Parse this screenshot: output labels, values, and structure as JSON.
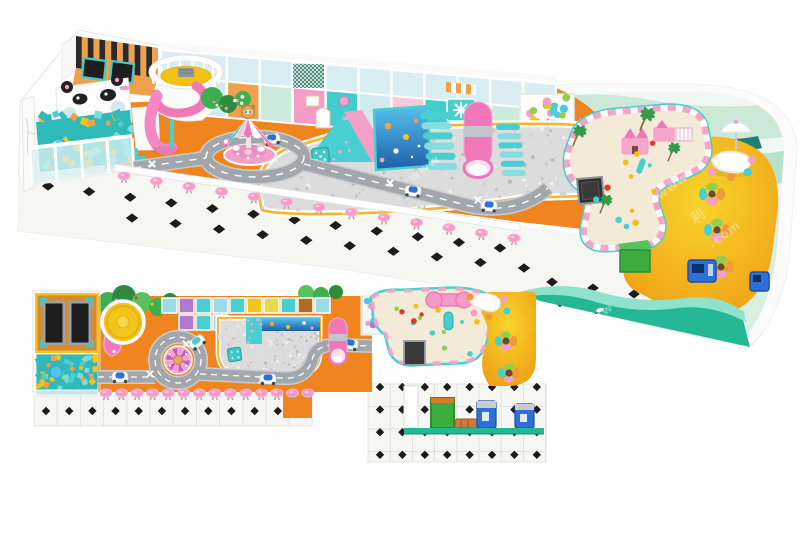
{
  "meta": {
    "subject": "indoor playground 3d design render",
    "views": [
      "perspective-render",
      "top-down-floor-plan"
    ]
  },
  "palette": {
    "orange": "#F0841E",
    "orangeSoft": "#F29A3E",
    "orangeWall": "#F0A04A",
    "yellow": "#F2C51D",
    "gold": "#F6B52A",
    "pink": "#F49BC8",
    "pinkHot": "#F078B8",
    "pinkPale": "#F6C9DD",
    "teal": "#43CCCC",
    "tealDeep": "#2FA8A8",
    "glass": "#D8EEF2",
    "mint": "#CDEBDC",
    "mintDark": "#A8DCC4",
    "waveDark": "#1E7F72",
    "road": "#A2A7AB",
    "roadLight": "#C9CDD0",
    "ballGrey": "#DCDCDC",
    "dark": "#2A2A2A",
    "sand": "#F3EAD8",
    "tile": "#F6F6F2",
    "tileLine": "#DEDED8",
    "green": "#3FAE4E",
    "greenDark": "#2E8B3D",
    "boxGreen": "#3DAE3D",
    "blue": "#2E6FD8",
    "blueDark": "#1D4FA8",
    "red": "#E03A2F",
    "purple": "#B07AD0",
    "trim": "#25B894",
    "trimLight": "#8FE3CE",
    "white": "#FFFFFF",
    "frame": "#E8ECEA",
    "bear": "#E0A860"
  },
  "watermark": {
    "fragments": [
      "www",
      ".com",
      "乐",
      "利"
    ]
  },
  "zones": {
    "perspective": [
      "trampoline-room",
      "panda-partition",
      "foam-cube-pit",
      "spiral-slide-tower",
      "carousel",
      "toy-road",
      "play-structure-panels",
      "white-ball-pit",
      "climbing-wedge",
      "ocean-mural",
      "roller-stairs",
      "tube-slide",
      "castle-arches",
      "ball-pool",
      "sand-play-area",
      "cafe-area",
      "bean-table",
      "pink-stool-row",
      "tile-floor",
      "wavy-wall",
      "arcade-machines",
      "storage-box"
    ],
    "plan": [
      "trampoline-room",
      "foam-cube-pit",
      "slide-tower",
      "tree-band",
      "panel-grid",
      "ball-pit",
      "tube-slide",
      "ball-pool",
      "toy-road",
      "roundabout-carousel",
      "sand-play-area",
      "chalkboard",
      "cafe-area",
      "stool-row",
      "tile-floor",
      "machines",
      "storage-box"
    ]
  },
  "gen": {
    "u_stripes": {
      "type": "stripes",
      "quad": [
        [
          76,
          36
        ],
        [
          158,
          48
        ],
        [
          158,
          78
        ],
        [
          76,
          68
        ]
      ],
      "n": 14,
      "colors": [
        "#2A2A2A",
        "#F0A04A"
      ]
    },
    "u_foam": {
      "type": "cubes",
      "rect": [
        40,
        114,
        92,
        54
      ],
      "n": 64,
      "size": [
        4,
        8
      ],
      "colors": [
        "#49CFCF",
        "#F0A04A",
        "#F2C51D",
        "#7ADCDC",
        "#2FB9B9",
        "#38B8B8"
      ],
      "seed": 7,
      "clip": "clipFoamU"
    },
    "u_panels": {
      "type": "panels",
      "x1": 161,
      "y1": 50,
      "x2": 556,
      "y2": 84,
      "n": 12,
      "hTop": 26,
      "hBot": 36,
      "glass": "#D8EEF2",
      "colors": [
        "#F6C9DD",
        "#CFEAF0",
        "#F0A04A",
        "#CDEBDC",
        "#F49BC8",
        "#43CCCC",
        "#CFEAF0",
        "#F6C9DD",
        "#43CCCC",
        "#F0A04A",
        "#CDEBDC",
        "#CFEAF0"
      ]
    },
    "u_net": {
      "type": "net",
      "rect": [
        293,
        64,
        31,
        24
      ],
      "step": 4,
      "color": "#2E6E4E"
    },
    "u_awning": {
      "type": "stripes",
      "quad": [
        [
          446,
          82
        ],
        [
          476,
          85
        ],
        [
          476,
          95
        ],
        [
          446,
          92
        ]
      ],
      "n": 6,
      "colors": [
        "#F0A04A",
        "#FFFFFF"
      ]
    },
    "u_bushdots": {
      "type": "balls",
      "rect": [
        202,
        90,
        46,
        22
      ],
      "n": 10,
      "r": [
        1,
        2
      ],
      "colors": [
        "#F49BC8",
        "#F0A04A",
        "#FFFFFF"
      ],
      "seed": 3
    },
    "u_rails": {
      "type": "rails",
      "cx": 186,
      "cy": 72,
      "rx": 33,
      "ry": 13.5,
      "n": 12,
      "len": 10,
      "color": "#FFFFFF",
      "a0": 150,
      "a1": 390
    },
    "u_sectors": {
      "type": "sectors",
      "cx": 248,
      "cy": 144,
      "rx": 23,
      "ry": 8.5,
      "apex": [
        248,
        118
      ],
      "n": 9,
      "colors": [
        "#F078B8",
        "#FFFFFF",
        "#49CFCF",
        "#F6C9DD"
      ],
      "a0": 160,
      "a1": 380,
      "dots": true
    },
    "u_speckle": {
      "type": "balls",
      "rect": [
        260,
        128,
        352,
        88
      ],
      "n": 240,
      "r": [
        1,
        2.3
      ],
      "colors": [
        "#C9C9C9",
        "#EFEFEF",
        "#BDBDBD",
        "#E2E2E2",
        "#D4D4D4"
      ],
      "seed": 13,
      "clip": "clipPitU"
    },
    "u_wedgedots": {
      "type": "balls",
      "rect": [
        312,
        118,
        54,
        42
      ],
      "n": 13,
      "r": [
        1.2,
        1.9
      ],
      "colors": [
        "#F6A8CC"
      ],
      "seed": 5,
      "clip": "clipWedge"
    },
    "u_castleballs": {
      "type": "balls",
      "rect": [
        524,
        97,
        46,
        26
      ],
      "n": 16,
      "r": [
        3,
        4.4
      ],
      "colors": [
        "#8FD14F",
        "#4FC8E8",
        "#B07AD0",
        "#F2A0C8",
        "#F6C51D",
        "#49CFCF"
      ],
      "seed": 9
    },
    "u_bars1": {
      "type": "bars",
      "x": 420,
      "y": 112,
      "w": 30,
      "h": 7,
      "n": 6,
      "dx": 1.4,
      "dy": 10.2,
      "colors": [
        "#49CFCF",
        "#85DEDE"
      ]
    },
    "u_bars2": {
      "type": "bars",
      "x": 496,
      "y": 124,
      "w": 24,
      "h": 6,
      "n": 6,
      "dx": 1.2,
      "dy": 9.2,
      "colors": [
        "#49CFCF",
        "#85DEDE"
      ]
    },
    "u_sandtoys": {
      "type": "balls",
      "rect": [
        586,
        130,
        104,
        104
      ],
      "n": 12,
      "r": [
        2,
        3.4
      ],
      "colors": [
        "#E03A2F",
        "#F2C113",
        "#8FD14F",
        "#49CFCF"
      ],
      "seed": 21,
      "clip": "clipSandU"
    },
    "u_palms": {
      "type": "palms",
      "items": [
        [
          573,
          140,
          1
        ],
        [
          640,
          124,
          1.1
        ],
        [
          668,
          156,
          0.9
        ],
        [
          600,
          208,
          0.9
        ]
      ]
    },
    "u_stools": {
      "type": "stools",
      "from": [
        124,
        176
      ],
      "to": [
        514,
        238
      ],
      "n": 13,
      "top": "#F49BC8",
      "base": "#9AA0A4"
    },
    "u_dia1": {
      "type": "diamonds",
      "from": [
        48,
        186
      ],
      "to": [
        500,
        248
      ],
      "n": 12,
      "s": 4.6,
      "sq": 1.35
    },
    "u_dia2": {
      "type": "diamonds",
      "from": [
        132,
        218
      ],
      "to": [
        524,
        268
      ],
      "n": 10,
      "s": 4.6,
      "sq": 1.35
    },
    "u_dia3": {
      "type": "diamonds",
      "from": [
        560,
        302
      ],
      "to": [
        740,
        338
      ],
      "n": 6,
      "s": 5,
      "sq": 1.3
    },
    "u_dia4": {
      "type": "diamonds",
      "from": [
        552,
        282
      ],
      "to": [
        716,
        306
      ],
      "n": 5,
      "s": 4.5,
      "sq": 1.3
    },
    "u_beanchairs": {
      "type": "dots",
      "items": [
        [
          706,
          160,
          4,
          "#F09A3E"
        ],
        [
          752,
          160,
          4,
          "#F2A0C8"
        ],
        [
          748,
          172,
          4,
          "#49CFCF"
        ],
        [
          712,
          172,
          4,
          "#F2A0C8"
        ],
        [
          731,
          177,
          4,
          "#F09A3E"
        ]
      ]
    },
    "u_clusters": {
      "type": "chairs",
      "items": [
        [
          712,
          194
        ],
        [
          717,
          230
        ],
        [
          721,
          267
        ]
      ],
      "off": 9,
      "rx": 6,
      "ry": 4,
      "colors": [
        "#F09A3E",
        "#F2A0C8",
        "#49CFCF",
        "#8FD14F"
      ],
      "table": "#6B4A32"
    },
    "u_cars": {
      "type": "cars",
      "items": [
        [
          272,
          139,
          -10
        ],
        [
          413,
          191,
          6
        ],
        [
          489,
          206,
          3
        ]
      ],
      "canopy": "#2E6FD8"
    },
    "u_x": {
      "type": "xmarks",
      "items": [
        [
          152,
          164
        ],
        [
          390,
          183
        ],
        [
          478,
          200
        ]
      ]
    },
    "u_murfish": {
      "type": "dots",
      "items": [
        [
          388,
          126,
          3.4,
          "#F0A04A"
        ],
        [
          406,
          137,
          3,
          "#F2C51D"
        ],
        [
          396,
          151,
          2.6,
          "#FFFFFF"
        ],
        [
          416,
          121,
          2.2,
          "#F0A04A"
        ],
        [
          419,
          146,
          1.4,
          "#FFFFFF"
        ],
        [
          412,
          157,
          1.2,
          "#FFFFFF"
        ],
        [
          382,
          160,
          2.4,
          "#F2A0C8"
        ]
      ]
    },
    "p_grid1": {
      "type": "grid",
      "rect": [
        34,
        396,
        278,
        30
      ],
      "dx": 23.2,
      "dy": 30,
      "color": "#DEDED8"
    },
    "p_dia1": {
      "type": "diamonds",
      "from": [
        46,
        411
      ],
      "to": [
        301,
        411
      ],
      "n": 12,
      "s": 4.2,
      "sq": 1
    },
    "p_grid2": {
      "type": "grid",
      "rect": [
        368,
        384,
        178,
        78
      ],
      "dx": 22.2,
      "dy": 22.5,
      "color": "#DEDED8"
    },
    "p_dia2": {
      "type": "diagrid",
      "x0": 380,
      "y0": 387,
      "dx": 22.4,
      "dy": 22.6,
      "cols": 8,
      "rows": 4,
      "s": 4.2,
      "sq": 1
    },
    "p_foam": {
      "type": "cubes",
      "rect": [
        38,
        356,
        58,
        34
      ],
      "n": 48,
      "size": [
        3.5,
        6
      ],
      "colors": [
        "#49CFCF",
        "#F0A04A",
        "#F2C51D",
        "#7ADCDC",
        "#2FB9B9"
      ],
      "seed": 11
    },
    "p_trees": {
      "type": "blobs",
      "circles": [
        [
          108,
          303,
          11
        ],
        [
          124,
          297,
          12
        ],
        [
          142,
          302,
          10
        ],
        [
          158,
          307,
          9
        ],
        [
          170,
          301,
          8
        ],
        [
          306,
          293,
          8
        ],
        [
          321,
          295,
          8
        ],
        [
          336,
          292,
          7
        ]
      ],
      "colors": [
        "#3FAE4E",
        "#2E8B3D",
        "#57C25E"
      ]
    },
    "p_treedots": {
      "type": "dots",
      "items": [
        [
          116,
          300,
          1.5,
          "#F0A04A"
        ],
        [
          136,
          298,
          1.5,
          "#E03A2F"
        ],
        [
          152,
          304,
          1.5,
          "#F2C51D"
        ]
      ]
    },
    "p_cells": {
      "type": "cells",
      "x": 162,
      "y": 298,
      "s": 15,
      "gap": 2,
      "colors": [
        "#9ADBE8",
        "#B07AD0",
        "#49CFCF",
        "#9ADBE8",
        "#49CFCF",
        "#F2C51D",
        "#E8D84A",
        "#49CFCF",
        "#B06A2A",
        "#9ADBE8"
      ],
      "extra": [
        [
          179,
          315,
          "#B07AD0"
        ],
        [
          196,
          315,
          "#49CFCF"
        ],
        [
          213,
          315,
          "#9ADBE8"
        ]
      ]
    },
    "p_poolballs": {
      "type": "balls",
      "rect": [
        365,
        299,
        32,
        32
      ],
      "n": 15,
      "r": [
        2.4,
        3.4
      ],
      "colors": [
        "#8FD14F",
        "#4FC8E8",
        "#B07AD0",
        "#F2A0C8",
        "#F6C51D",
        "#49CFCF"
      ],
      "seed": 17
    },
    "p_speckle": {
      "type": "balls",
      "rect": [
        219,
        319,
        100,
        54
      ],
      "n": 130,
      "r": [
        0.8,
        1.7
      ],
      "colors": [
        "#C9C9C9",
        "#EFEFEF",
        "#BDBDBD",
        "#E0E0E0"
      ],
      "seed": 19,
      "clip": "clipPitP"
    },
    "p_tealdots": {
      "type": "balls",
      "rect": [
        247,
        319,
        14,
        24
      ],
      "n": 8,
      "r": [
        1,
        1.5
      ],
      "colors": [
        "#F6A8CC"
      ],
      "seed": 23
    },
    "p_sandtoys": {
      "type": "balls",
      "rect": [
        392,
        300,
        88,
        58
      ],
      "n": 12,
      "r": [
        2,
        3
      ],
      "colors": [
        "#E03A2F",
        "#F2C113",
        "#8FD14F",
        "#49CFCF"
      ],
      "seed": 25,
      "clip": "clipSandP"
    },
    "p_stools": {
      "type": "stools",
      "from": [
        106,
        393
      ],
      "to": [
        308,
        393
      ],
      "n": 14,
      "top": "#F49BC8",
      "base": "#9AA0A4"
    },
    "p_sectors": {
      "type": "sectors",
      "cx": 178,
      "cy": 360,
      "rx": 12.5,
      "ry": 12.5,
      "apex": [
        178,
        360
      ],
      "n": 12,
      "colors": [
        "#C85AC0",
        "#F49BC8"
      ],
      "a0": 0,
      "a1": 360,
      "dots": false
    },
    "p_cars": {
      "type": "cars",
      "items": [
        [
          120,
          377,
          0
        ],
        [
          268,
          379,
          0
        ],
        [
          350,
          344,
          10
        ],
        [
          197,
          342,
          -35,
          "#49CFCF"
        ]
      ],
      "canopy": "#2E6FD8"
    },
    "p_x": {
      "type": "xmarks",
      "items": [
        [
          150,
          374
        ],
        [
          262,
          380
        ],
        [
          344,
          352
        ],
        [
          186,
          344
        ]
      ]
    },
    "p_beanchairs": {
      "type": "dots",
      "items": [
        [
          470,
          297,
          3.5,
          "#F09A3E"
        ],
        [
          504,
          299,
          3.5,
          "#F2A0C8"
        ],
        [
          507,
          311,
          3.5,
          "#49CFCF"
        ],
        [
          474,
          313,
          3.5,
          "#F2A0C8"
        ],
        [
          489,
          317,
          3.5,
          "#F09A3E"
        ]
      ]
    },
    "p_clusters": {
      "type": "chairs",
      "items": [
        [
          506,
          341
        ],
        [
          509,
          373
        ]
      ],
      "off": 7.5,
      "rx": 5,
      "ry": 3.6,
      "colors": [
        "#F09A3E",
        "#F2A0C8",
        "#49CFCF",
        "#8FD14F"
      ],
      "table": "#6B4A32"
    },
    "p_murfish": {
      "type": "dots",
      "items": [
        [
          272,
          324,
          2.2,
          "#F0A04A"
        ],
        [
          288,
          327,
          2,
          "#F2C51D"
        ],
        [
          304,
          323,
          1.8,
          "#FFFFFF"
        ],
        [
          312,
          328,
          1.6,
          "#F2A0C8"
        ]
      ]
    },
    "p_shovels": {
      "type": "dots",
      "items": [
        [
          420,
          318,
          2.2,
          "#8FD14F"
        ],
        [
          444,
          332,
          2.2,
          "#8FD14F"
        ],
        [
          462,
          322,
          2,
          "#49CFCF"
        ]
      ]
    },
    "wm": {
      "type": "texts",
      "items": [
        {
          "t": "www",
          "x": 412,
          "y": 182,
          "r": -36,
          "s": 12
        },
        {
          "t": "乐",
          "x": 737,
          "y": 176,
          "r": -36,
          "s": 14
        },
        {
          "t": "www",
          "x": 660,
          "y": 200,
          "r": -36,
          "s": 12
        },
        {
          "t": "利",
          "x": 695,
          "y": 224,
          "r": -36,
          "s": 14
        },
        {
          "t": ".com",
          "x": 712,
          "y": 248,
          "r": -36,
          "s": 12
        },
        {
          "t": "www",
          "x": 585,
          "y": 330,
          "r": -36,
          "s": 12
        }
      ]
    }
  }
}
